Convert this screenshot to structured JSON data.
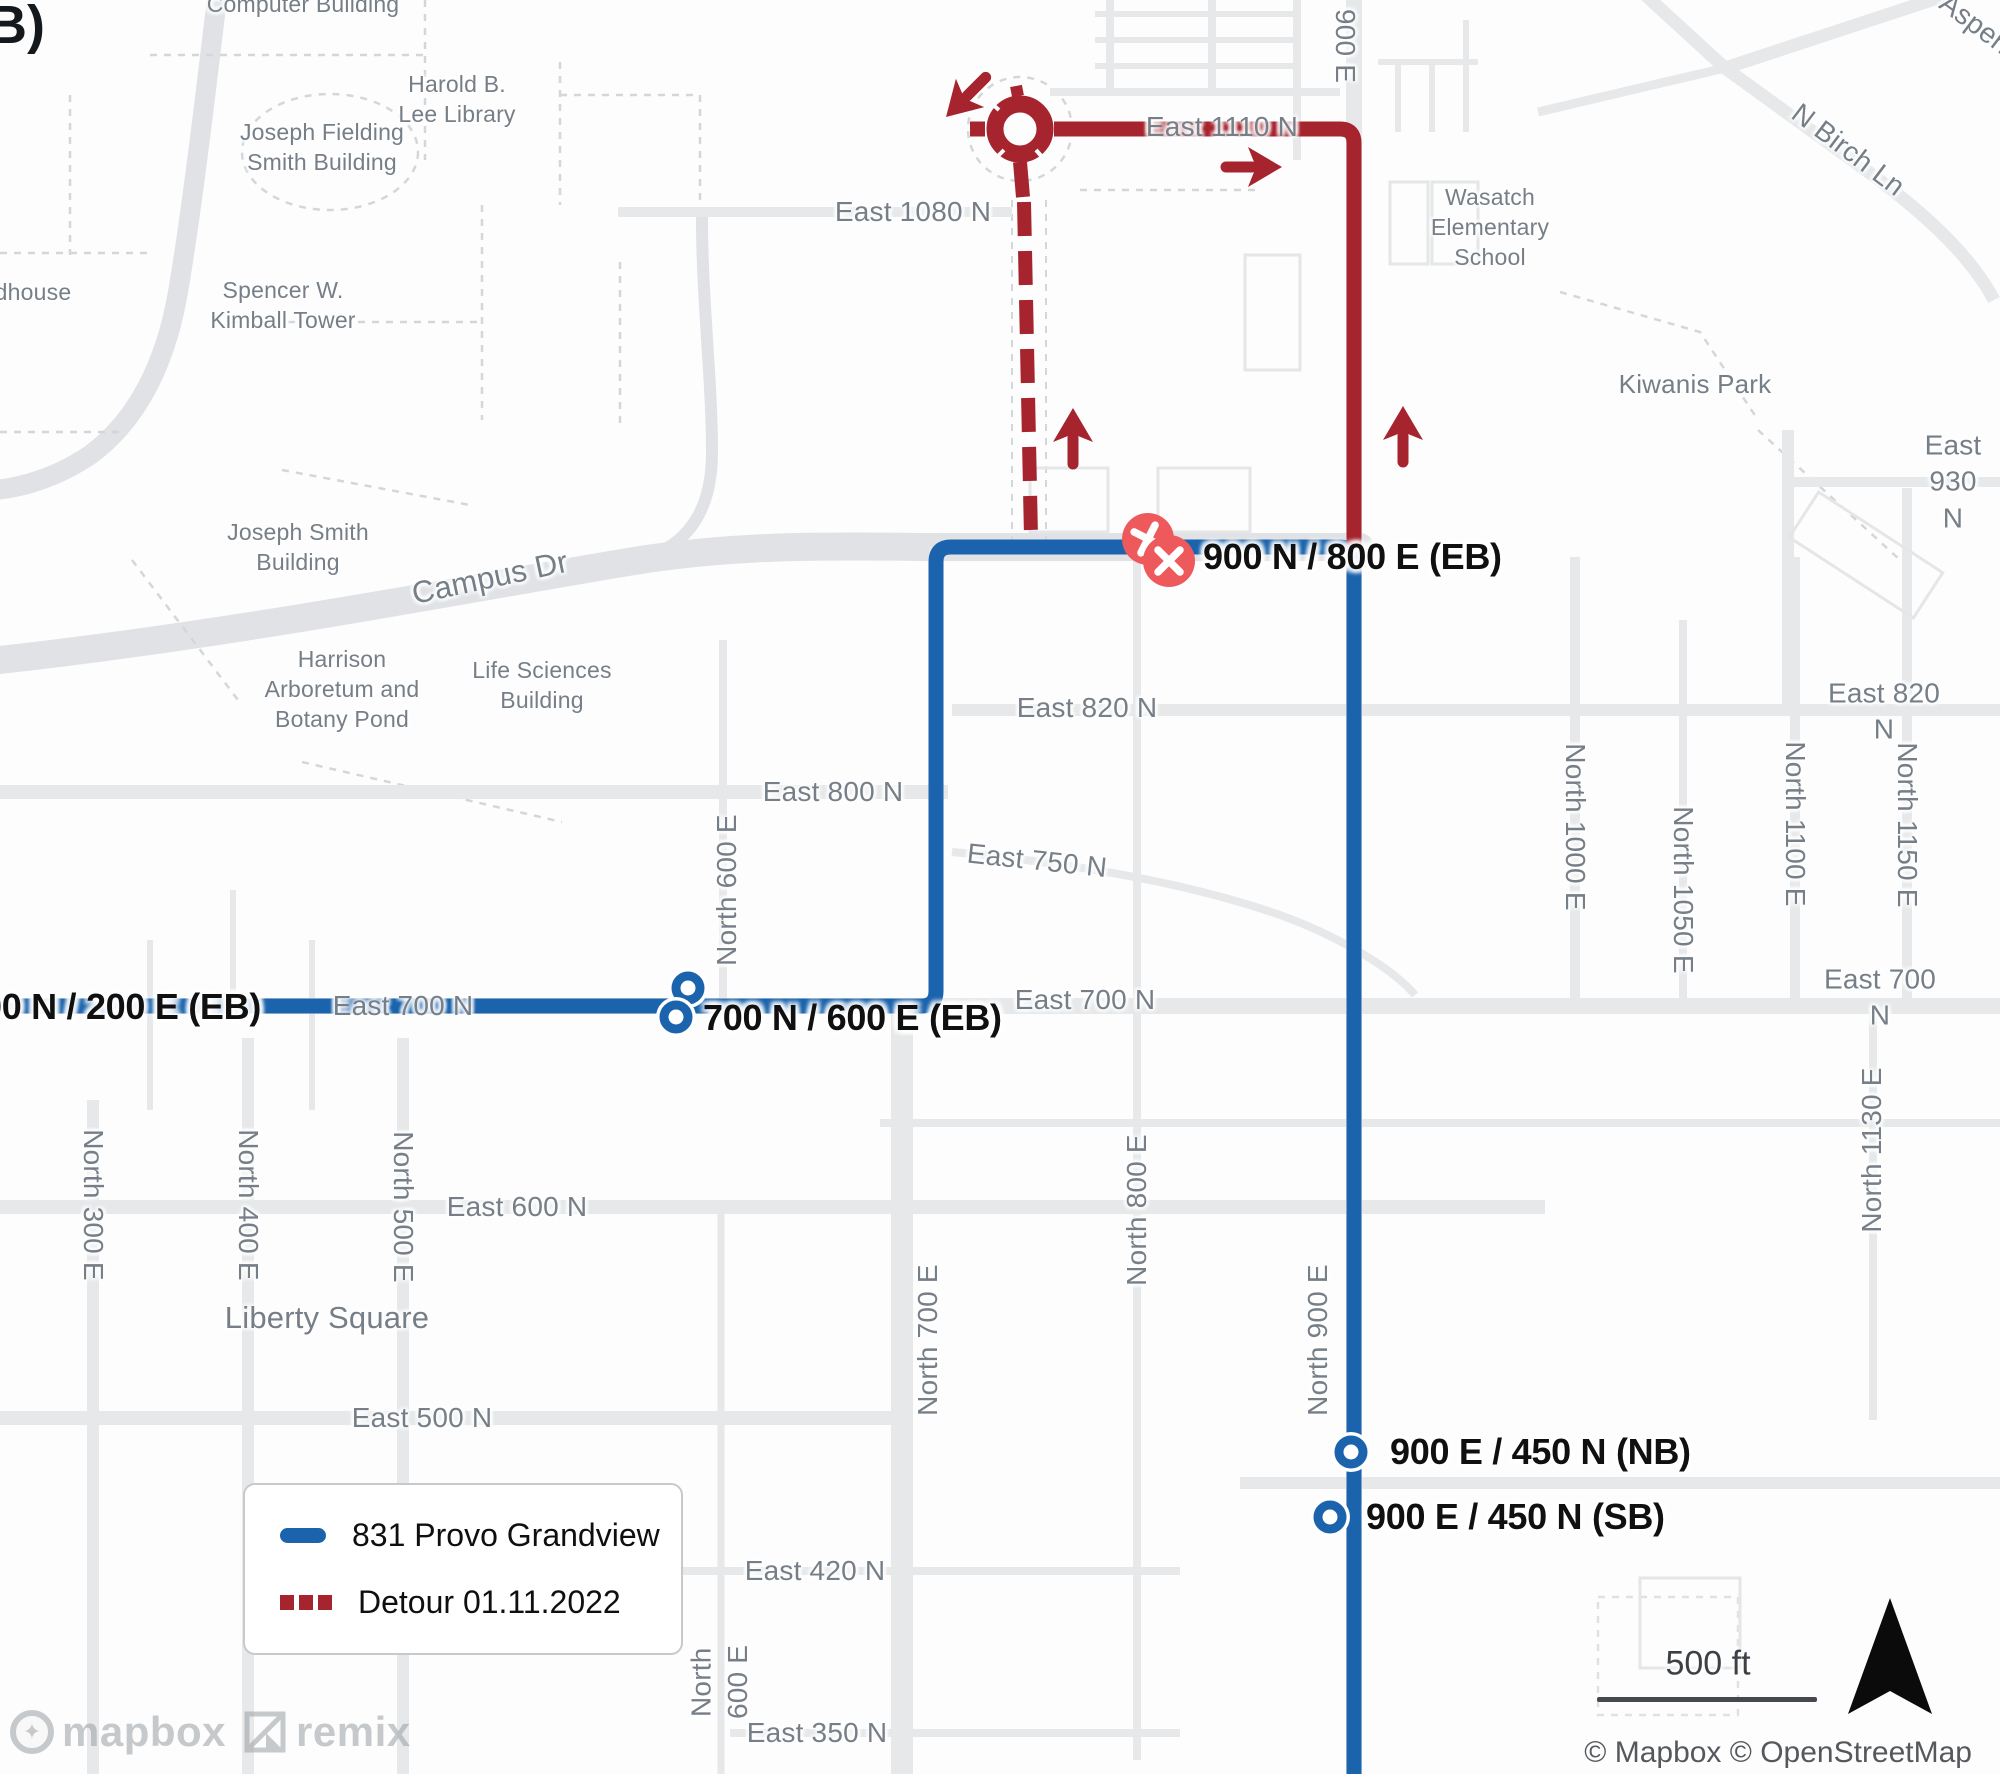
{
  "figure_label": "B)",
  "legend": {
    "items": [
      {
        "label": "831 Provo Grandview",
        "swatch": "blue-solid-line"
      },
      {
        "label": "Detour 01.11.2022",
        "swatch": "red-dashed-line"
      }
    ]
  },
  "stops": [
    {
      "label": "900 N / 800 E (EB)",
      "marker": "closed-x-circle"
    },
    {
      "label": "700 N / 600 E (EB)",
      "marker": "open-circle"
    },
    {
      "label": "00 N / 200 E (EB)",
      "marker": "open-circle"
    },
    {
      "label": "900 E / 450 N (NB)",
      "marker": "open-circle"
    },
    {
      "label": "900 E / 450 N (SB)",
      "marker": "open-circle"
    }
  ],
  "streets": [
    {
      "label": "East 1080 N"
    },
    {
      "label": "East 1110 N"
    },
    {
      "label": "900 E"
    },
    {
      "label": "East 930 N"
    },
    {
      "label": "East 820 N"
    },
    {
      "label": "East 820 N"
    },
    {
      "label": "East 800 N"
    },
    {
      "label": "East 750 N"
    },
    {
      "label": "East 700 N"
    },
    {
      "label": "East 700 N"
    },
    {
      "label": "East 700 N"
    },
    {
      "label": "East 600 N"
    },
    {
      "label": "East 500 N"
    },
    {
      "label": "East 420 N"
    },
    {
      "label": "East 350 N"
    },
    {
      "label": "Campus Dr"
    },
    {
      "label": "N Birch Ln"
    },
    {
      "label": "Aspen"
    },
    {
      "label": "North 300 E"
    },
    {
      "label": "North 400 E"
    },
    {
      "label": "North 500 E"
    },
    {
      "label": "North 600 E"
    },
    {
      "label": "North 600 E"
    },
    {
      "label": "North 700 E"
    },
    {
      "label": "North 800 E"
    },
    {
      "label": "North 900 E"
    },
    {
      "label": "North 1000 E"
    },
    {
      "label": "North 1050 E"
    },
    {
      "label": "North 1100 E"
    },
    {
      "label": "North 1150 E"
    },
    {
      "label": "North 1130 E"
    }
  ],
  "pois": [
    {
      "label": "Computer Building"
    },
    {
      "label": "Harold B.\nLee Library"
    },
    {
      "label": "Joseph Fielding\nSmith Building"
    },
    {
      "label": "dhouse"
    },
    {
      "label": "Spencer W.\nKimball Tower"
    },
    {
      "label": "Joseph Smith\nBuilding"
    },
    {
      "label": "Harrison\nArboretum and\nBotany Pond"
    },
    {
      "label": "Life Sciences\nBuilding"
    },
    {
      "label": "Wasatch\nElementary\nSchool"
    },
    {
      "label": "Kiwanis Park"
    },
    {
      "label": "Liberty Square"
    }
  ],
  "scale": {
    "label": "500 ft"
  },
  "attribution": {
    "text": "© Mapbox © OpenStreetMap"
  },
  "watermarks": {
    "mapbox": "mapbox",
    "remix": "remix"
  },
  "colors": {
    "route_blue": "#1b64ad",
    "detour_red": "#a6242e",
    "closed_stop_red": "#ee5a5c",
    "road_gray": "#e6e8ea",
    "label_gray": "#767e87"
  }
}
